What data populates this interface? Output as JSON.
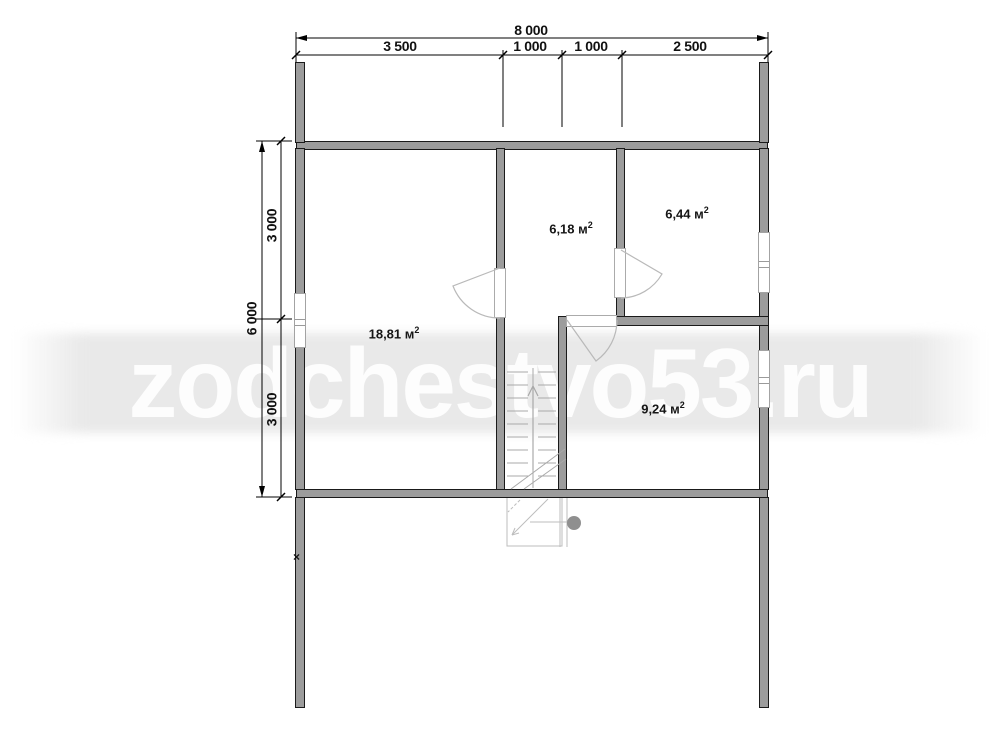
{
  "watermark": {
    "text": "zodchestvo53.ru"
  },
  "dimensions": {
    "top": {
      "total": "8 000",
      "segments": [
        "3 500",
        "1 000",
        "1 000",
        "2 500"
      ]
    },
    "left": {
      "total": "6 000",
      "segments": [
        "3 000",
        "3 000"
      ]
    }
  },
  "rooms": [
    {
      "area": "18,81 м",
      "sup": "2"
    },
    {
      "area": "6,18 м",
      "sup": "2"
    },
    {
      "area": "6,44 м",
      "sup": "2"
    },
    {
      "area": "9,24 м",
      "sup": "2"
    }
  ],
  "markers": {
    "wall_break": "×"
  },
  "colors": {
    "wall_fill": "#9c9c9c",
    "wall_outline": "#1a1a1a",
    "thin_line": "#b5b5b5",
    "dimension_line": "#000000",
    "watermark_band": "#e9e9e9",
    "watermark_text": "#fdfdfd"
  }
}
